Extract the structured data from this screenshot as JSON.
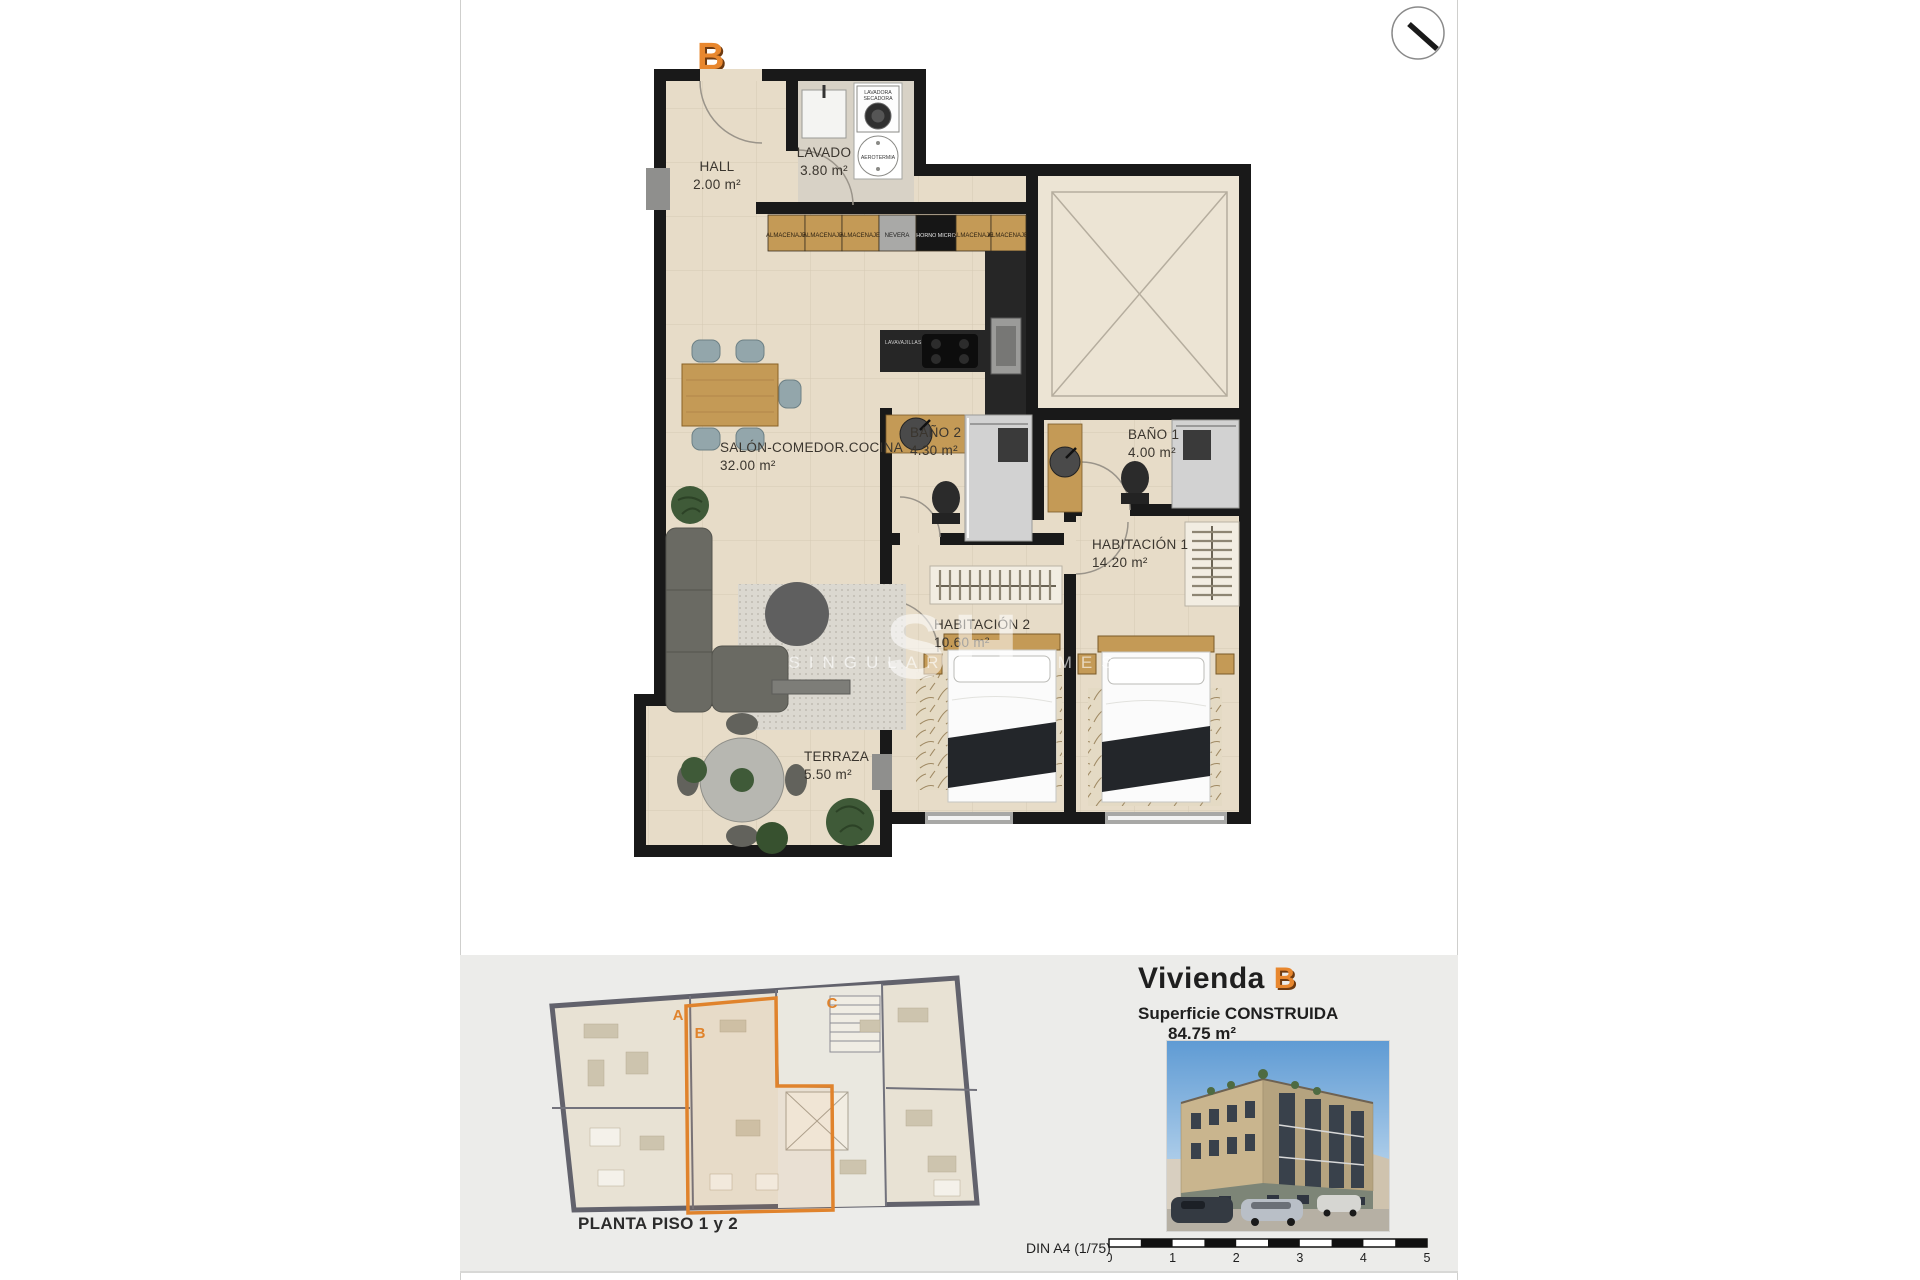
{
  "document": {
    "unit_badge": "B",
    "watermark": {
      "initials": "SH",
      "name": "SINGULARITY HOMES"
    }
  },
  "floor_plan": {
    "rooms": [
      {
        "name": "HALL",
        "area": "2.00 m²"
      },
      {
        "name": "LAVADO",
        "area": "3.80 m²"
      },
      {
        "name": "SALÓN-COMEDOR.COCINA",
        "area": "32.00 m²"
      },
      {
        "name": "BAÑO 2",
        "area": "4.30 m²"
      },
      {
        "name": "BAÑO 1",
        "area": "4.00 m²"
      },
      {
        "name": "HABITACIÓN 1",
        "area": "14.20 m²"
      },
      {
        "name": "HABITACIÓN 2",
        "area": "10.60 m²"
      },
      {
        "name": "TERRAZA",
        "area": "5.50 m²"
      }
    ],
    "kitchen_units": [
      "ALMACENAJE",
      "ALMACENAJE",
      "ALMACENAJE",
      "NEVERA",
      "HORNO MICRO",
      "ALMACENAJE",
      "ALMACENAJE"
    ],
    "appliances": {
      "washer_dryer_line1": "LAVADORA",
      "washer_dryer_line2": "SECADORA",
      "heat_pump": "AEROTERMIA",
      "dishwasher": "LAVAVAJILLAS"
    }
  },
  "overview": {
    "caption": "PLANTA PISO 1 y 2",
    "units": [
      {
        "letter": "A"
      },
      {
        "letter": "B"
      },
      {
        "letter": "C"
      }
    ]
  },
  "summary": {
    "dwelling_label": "Vivienda",
    "dwelling_letter": "B",
    "surface_label": "Superficie CONSTRUIDA",
    "surface_value": "84.75 m²"
  },
  "scale": {
    "label": "DIN A4 (1/75)",
    "ticks": [
      "0",
      "1",
      "2",
      "3",
      "4",
      "5"
    ]
  },
  "colors": {
    "accent_orange": "#e0832c",
    "wall_black": "#191919",
    "floor_beige": "#e7dcc8",
    "panel_gray": "#ececea",
    "wood": "#c49a56"
  }
}
